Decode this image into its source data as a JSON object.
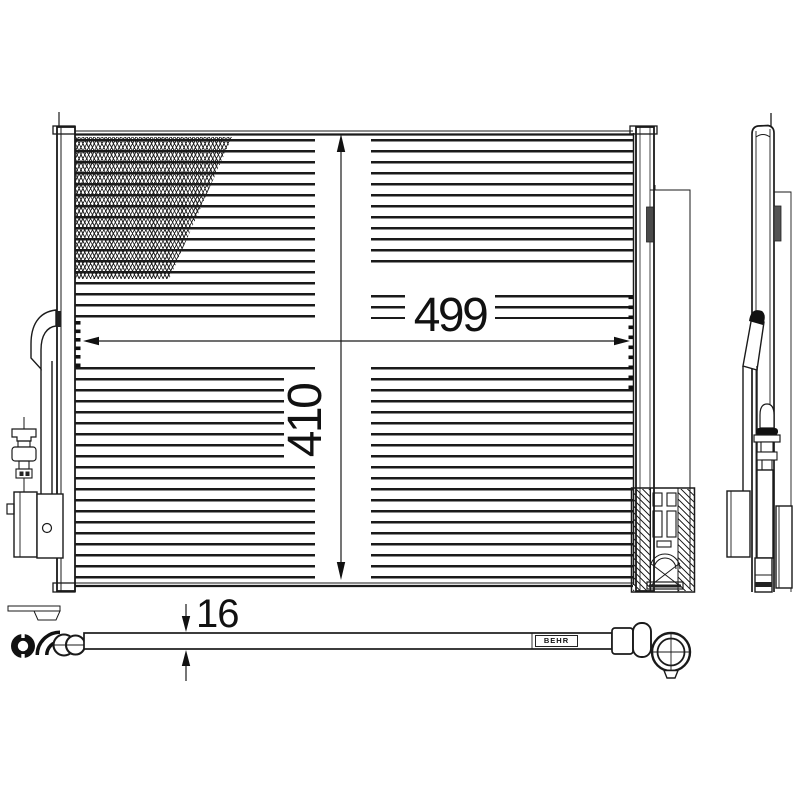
{
  "colors": {
    "background": "#ffffff",
    "line": "#1a1a1a",
    "pad_fill": "#555555"
  },
  "views": {
    "front": {
      "width_label": "499",
      "height_label": "410"
    },
    "bottom": {
      "thickness_label": "16",
      "brand_stamp": "BEHR"
    }
  }
}
